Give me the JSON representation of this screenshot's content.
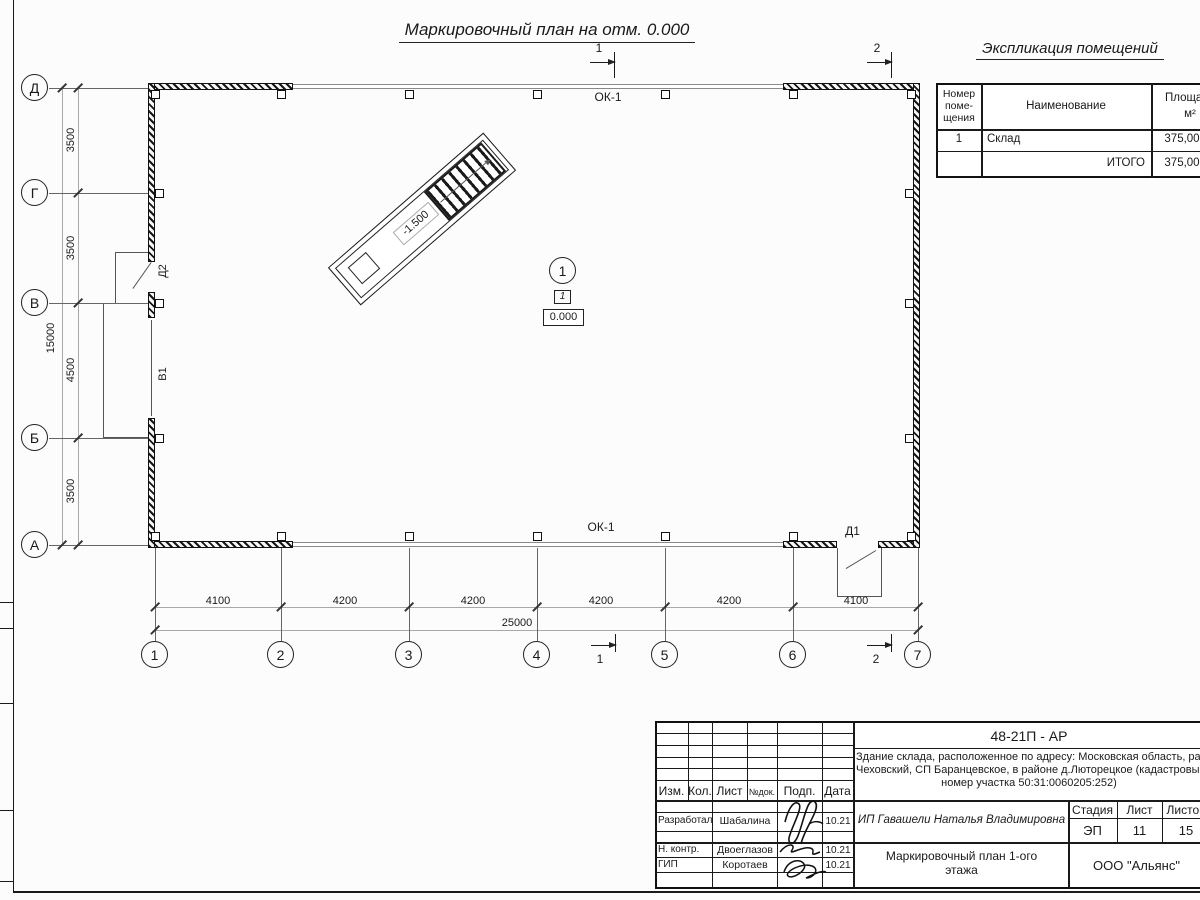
{
  "sheet_title": "Маркировочный план на отм. 0.000",
  "explication": {
    "title": "Экспликация  помещений",
    "col_num_l1": "Номер",
    "col_num_l2": "поме-",
    "col_num_l3": "щения",
    "col_name": "Наименование",
    "col_area": "Площадь",
    "col_area_unit": "м²",
    "rows": [
      {
        "num": "1",
        "name": "Склад",
        "area": "375,00"
      }
    ],
    "total_label": "ИТОГО",
    "total_area": "375,00"
  },
  "plan": {
    "axes_left": [
      "Д",
      "Г",
      "В",
      "Б",
      "А"
    ],
    "axes_bottom": [
      "1",
      "2",
      "3",
      "4",
      "5",
      "6",
      "7"
    ],
    "dims_left": [
      "3500",
      "3500",
      "4500",
      "3500"
    ],
    "dim_left_total": "15000",
    "dims_bottom": [
      "4100",
      "4200",
      "4200",
      "4200",
      "4200",
      "4100"
    ],
    "dim_bottom_total": "25000",
    "labels": {
      "ok1_top": "ОК-1",
      "ok1_bottom": "ОК-1",
      "d1": "Д1",
      "d2": "Д2",
      "v1": "В1",
      "ramp_elev": "-1.500",
      "room_number": "1",
      "room_tag": "1",
      "floor_elev": "0.000"
    },
    "sections": {
      "s1": "1",
      "s2": "2"
    }
  },
  "titleblock": {
    "doc_code": "48-21П - АР",
    "address_line1": "Здание склада, расположенное по адресу: Московская область, район",
    "address_line2": "Чеховский, СП Баранцевское, в районе д.Люторецкое  (кадастровый",
    "address_line3": "номер участка 50:31:0060205:252)",
    "header": {
      "izm": "Изм.",
      "kol": "Кол.",
      "list": "Лист",
      "ndoc": "№док.",
      "podp": "Подп.",
      "data": "Дата"
    },
    "rows": [
      {
        "role": "Разработал",
        "name": "Шабалина",
        "date": "10.21"
      },
      {
        "role": "Н. контр.",
        "name": "Двоеглазов",
        "date": "10.21"
      },
      {
        "role": "ГИП",
        "name": "Коротаев",
        "date": "10.21"
      }
    ],
    "client": "ИП Гавашели Наталья Владимировна",
    "stage_label": "Стадия",
    "sheet_label": "Лист",
    "sheets_label": "Листов",
    "stage": "ЭП",
    "sheet": "11",
    "sheets": "15",
    "drawing_name1": "Маркировочный план 1-ого",
    "drawing_name2": "этажа",
    "company": "ООО \"Альянс\""
  }
}
